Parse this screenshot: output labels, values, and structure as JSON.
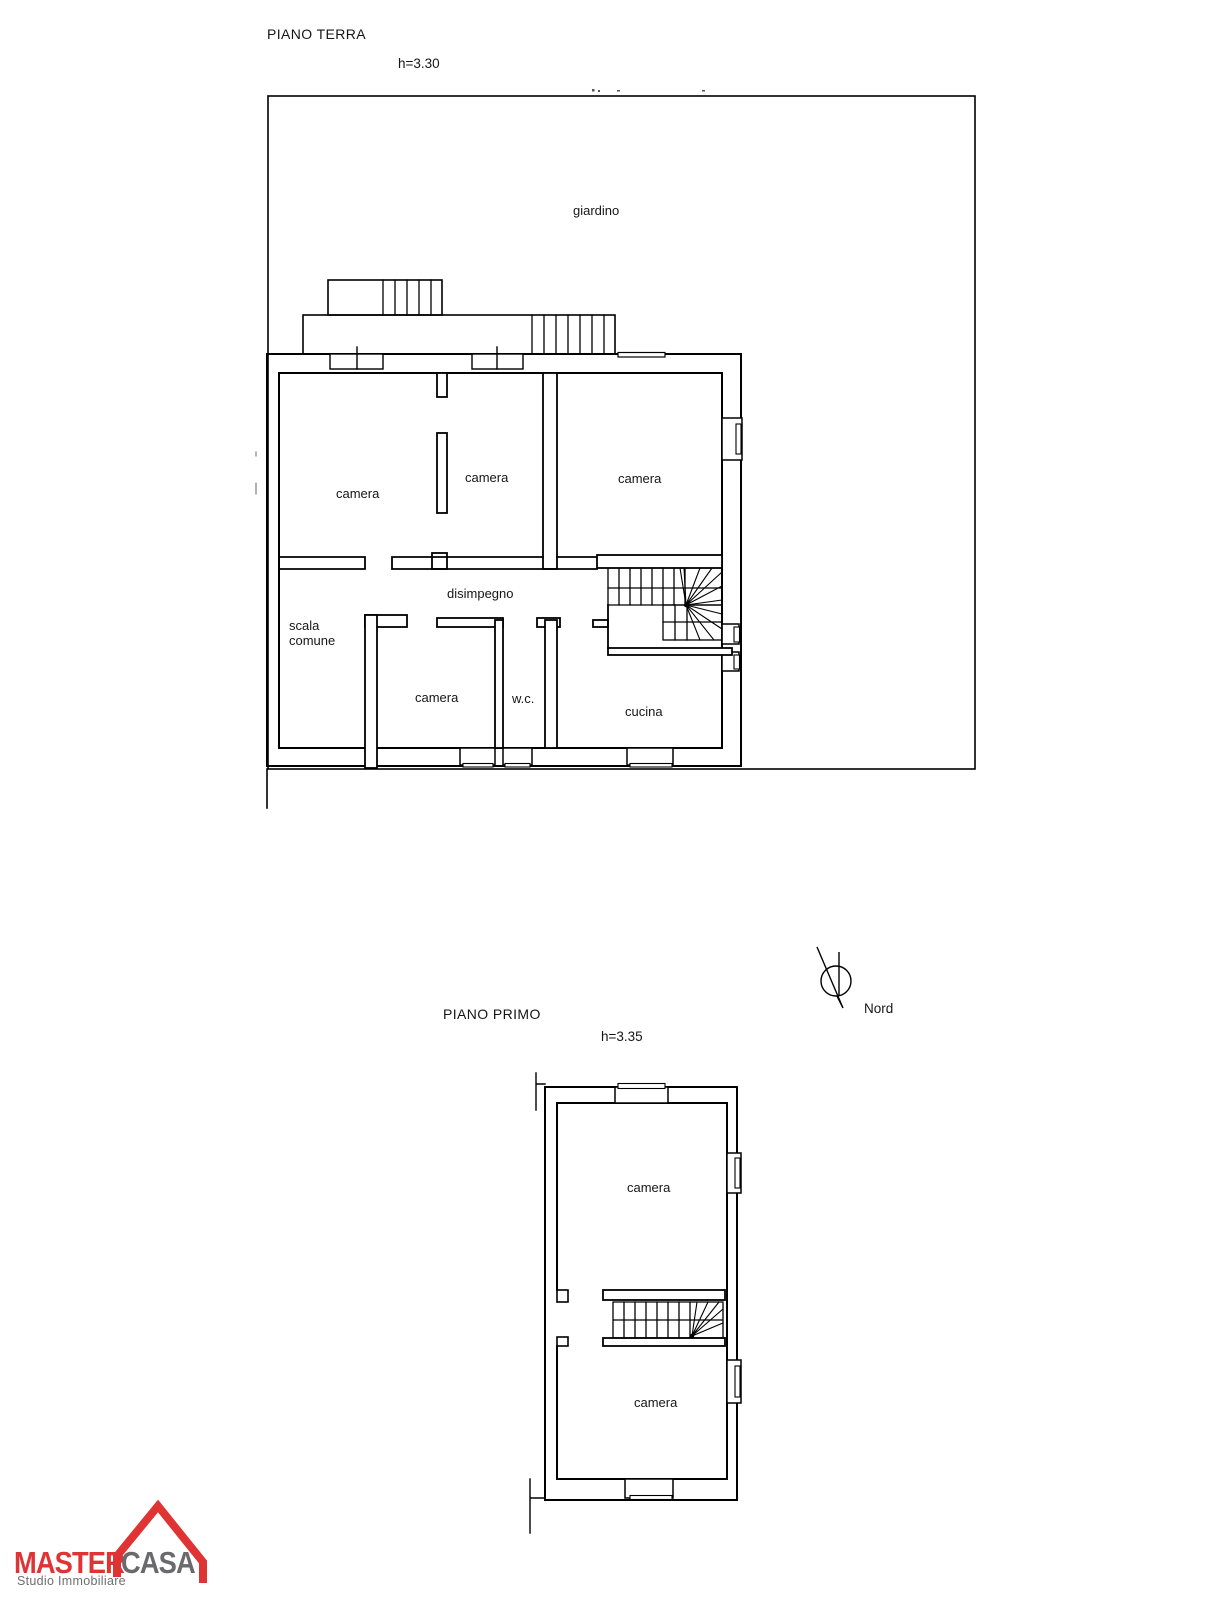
{
  "ground_floor": {
    "title": "PIANO TERRA",
    "height_label": "h=3.30",
    "labels": {
      "garden": "giardino",
      "camera_top_left": "camera",
      "camera_top_middle": "camera",
      "camera_top_right": "camera",
      "hallway": "disimpegno",
      "shared_stairs_line1": "scala",
      "shared_stairs_line2": "comune",
      "camera_bottom": "camera",
      "wc": "w.c.",
      "kitchen": "cucina"
    }
  },
  "first_floor": {
    "title": "PIANO PRIMO",
    "height_label": "h=3.35",
    "labels": {
      "camera_top": "camera",
      "camera_bottom": "camera"
    }
  },
  "compass": {
    "label": "Nord"
  },
  "logo": {
    "brand_master": "MASTER",
    "brand_casa": "CASA",
    "tagline": "Studio Immobiliare",
    "brand_red": "#DF3334",
    "brand_gray": "#6A6A6C"
  }
}
